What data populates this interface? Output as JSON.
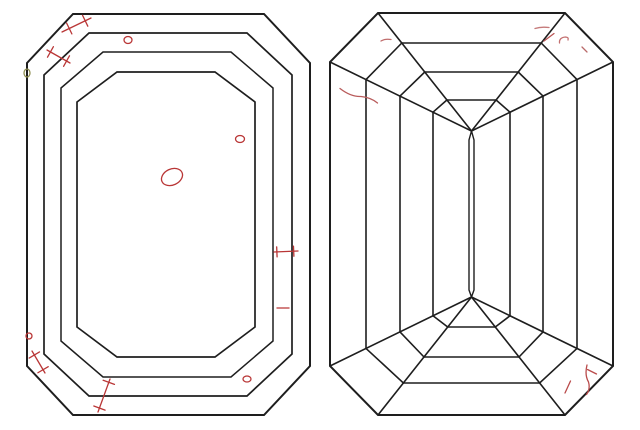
{
  "diagram": {
    "kind": "diamond-clarity-plot",
    "background": "#ffffff",
    "line_color": "#1e1e1e",
    "inclusion_color": "#b93636",
    "natural_color": "#8f8f52",
    "canvas": {
      "width": 640,
      "height": 430
    },
    "views": [
      {
        "name": "crown-view",
        "shapes": [
          {
            "type": "polygon",
            "name": "girdle-outline",
            "w": 2,
            "points": [
              [
                73,
                14
              ],
              [
                264,
                14
              ],
              [
                310,
                63
              ],
              [
                310,
                366
              ],
              [
                264,
                415
              ],
              [
                73,
                415
              ],
              [
                27,
                366
              ],
              [
                27,
                63
              ]
            ]
          },
          {
            "type": "polygon",
            "name": "crown-step-1",
            "w": 1.7,
            "points": [
              [
                89,
                33
              ],
              [
                247,
                33
              ],
              [
                292,
                75
              ],
              [
                292,
                354
              ],
              [
                247,
                396
              ],
              [
                89,
                396
              ],
              [
                44,
                354
              ],
              [
                44,
                75
              ]
            ]
          },
          {
            "type": "polygon",
            "name": "crown-step-2",
            "w": 1.5,
            "points": [
              [
                103,
                52
              ],
              [
                231,
                52
              ],
              [
                273,
                88
              ],
              [
                273,
                341
              ],
              [
                231,
                377
              ],
              [
                103,
                377
              ],
              [
                61,
                341
              ],
              [
                61,
                88
              ]
            ]
          },
          {
            "type": "polygon",
            "name": "table-outline",
            "w": 1.7,
            "points": [
              [
                117,
                72
              ],
              [
                215,
                72
              ],
              [
                255,
                102
              ],
              [
                255,
                327
              ],
              [
                215,
                357
              ],
              [
                117,
                357
              ],
              [
                77,
                327
              ],
              [
                77,
                102
              ]
            ]
          }
        ],
        "inclusions": [
          {
            "type": "feather",
            "name": "feather-mark",
            "x1": 62,
            "y1": 32,
            "x2": 91,
            "y2": 18,
            "ticks": [
              0.25,
              0.8
            ],
            "ticklen": 6
          },
          {
            "type": "feather",
            "name": "feather-mark",
            "x1": 47,
            "y1": 50,
            "x2": 70,
            "y2": 63,
            "ticks": [
              0.15,
              0.85
            ],
            "ticklen": 6
          },
          {
            "type": "ellipse",
            "name": "crystal-mark",
            "cx": 128,
            "cy": 40,
            "rx": 4,
            "ry": 3.5,
            "rot": 0
          },
          {
            "type": "ellipse",
            "name": "natural-mark",
            "cx": 27,
            "cy": 73,
            "rx": 3,
            "ry": 4,
            "rot": 0,
            "color": "#8f8f52"
          },
          {
            "type": "ellipse",
            "name": "crystal-mark",
            "cx": 172,
            "cy": 177,
            "rx": 11,
            "ry": 8,
            "rot": -25
          },
          {
            "type": "ellipse",
            "name": "crystal-mark",
            "cx": 240,
            "cy": 139,
            "rx": 4.5,
            "ry": 3.5,
            "rot": 0
          },
          {
            "type": "feather",
            "name": "feather-mark",
            "x1": 274,
            "y1": 252,
            "x2": 298,
            "y2": 251,
            "ticks": [
              0.12,
              0.82
            ],
            "ticklen": 5
          },
          {
            "type": "line",
            "name": "needle-mark",
            "x1": 277,
            "y1": 308,
            "x2": 289,
            "y2": 308
          },
          {
            "type": "ellipse",
            "name": "crystal-mark",
            "cx": 29,
            "cy": 336,
            "rx": 3,
            "ry": 3,
            "rot": 0
          },
          {
            "type": "feather",
            "name": "feather-mark",
            "x1": 32,
            "y1": 351,
            "x2": 45,
            "y2": 373,
            "ticks": [
              0.18,
              0.85
            ],
            "ticklen": 6
          },
          {
            "type": "feather",
            "name": "feather-mark",
            "x1": 110,
            "y1": 379,
            "x2": 98,
            "y2": 412,
            "ticks": [
              0.1,
              0.88
            ],
            "ticklen": 6
          },
          {
            "type": "ellipse",
            "name": "crystal-mark",
            "cx": 247,
            "cy": 379,
            "rx": 4,
            "ry": 3,
            "rot": 0
          }
        ]
      },
      {
        "name": "pavilion-view",
        "shapes": [
          {
            "type": "polygon",
            "name": "girdle-outline",
            "w": 2,
            "points": [
              [
                378,
                13
              ],
              [
                565,
                13
              ],
              [
                613,
                62
              ],
              [
                613,
                366
              ],
              [
                565,
                415
              ],
              [
                378,
                415
              ],
              [
                330,
                366
              ],
              [
                330,
                62
              ]
            ]
          },
          {
            "type": "line",
            "name": "corner-radial",
            "x1": 330,
            "y1": 62,
            "x2": 471.5,
            "y2": 131
          },
          {
            "type": "line",
            "name": "corner-radial",
            "x1": 378,
            "y1": 13,
            "x2": 471.5,
            "y2": 131
          },
          {
            "type": "line",
            "name": "corner-radial",
            "x1": 565,
            "y1": 13,
            "x2": 471.5,
            "y2": 131
          },
          {
            "type": "line",
            "name": "corner-radial",
            "x1": 613,
            "y1": 62,
            "x2": 471.5,
            "y2": 131
          },
          {
            "type": "line",
            "name": "corner-radial",
            "x1": 330,
            "y1": 366,
            "x2": 471.5,
            "y2": 297
          },
          {
            "type": "line",
            "name": "corner-radial",
            "x1": 378,
            "y1": 415,
            "x2": 471.5,
            "y2": 297
          },
          {
            "type": "line",
            "name": "corner-radial",
            "x1": 565,
            "y1": 415,
            "x2": 471.5,
            "y2": 297
          },
          {
            "type": "line",
            "name": "corner-radial",
            "x1": 613,
            "y1": 366,
            "x2": 471.5,
            "y2": 297
          },
          {
            "type": "line",
            "name": "pavilion-step-edge",
            "x1": 366,
            "y1": 79.6,
            "x2": 366,
            "y2": 348.4
          },
          {
            "type": "line",
            "name": "pavilion-step-edge",
            "x1": 400,
            "y1": 96.1,
            "x2": 400,
            "y2": 331.9
          },
          {
            "type": "line",
            "name": "pavilion-step-edge",
            "x1": 433,
            "y1": 112.2,
            "x2": 433,
            "y2": 315.8
          },
          {
            "type": "line",
            "name": "pavilion-step-edge",
            "x1": 577,
            "y1": 79.6,
            "x2": 577,
            "y2": 348.4
          },
          {
            "type": "line",
            "name": "pavilion-step-edge",
            "x1": 543,
            "y1": 96.1,
            "x2": 543,
            "y2": 331.9
          },
          {
            "type": "line",
            "name": "pavilion-step-edge",
            "x1": 510,
            "y1": 112.2,
            "x2": 510,
            "y2": 315.8
          },
          {
            "type": "line",
            "name": "pavilion-step-edge",
            "x1": 401.8,
            "y1": 43,
            "x2": 541.2,
            "y2": 43
          },
          {
            "type": "line",
            "name": "pavilion-step-edge",
            "x1": 424.8,
            "y1": 72,
            "x2": 518.2,
            "y2": 72
          },
          {
            "type": "line",
            "name": "pavilion-step-edge",
            "x1": 446.9,
            "y1": 100,
            "x2": 496.1,
            "y2": 100
          },
          {
            "type": "line",
            "name": "pavilion-step-edge",
            "x1": 403.4,
            "y1": 383,
            "x2": 539.6,
            "y2": 383
          },
          {
            "type": "line",
            "name": "pavilion-step-edge",
            "x1": 424,
            "y1": 357,
            "x2": 519,
            "y2": 357
          },
          {
            "type": "line",
            "name": "pavilion-step-edge",
            "x1": 447.7,
            "y1": 327,
            "x2": 495.3,
            "y2": 327
          },
          {
            "type": "line",
            "name": "corner-cut-line",
            "x1": 366,
            "y1": 79.6,
            "x2": 401.8,
            "y2": 43
          },
          {
            "type": "line",
            "name": "corner-cut-line",
            "x1": 400,
            "y1": 96.1,
            "x2": 424.8,
            "y2": 72
          },
          {
            "type": "line",
            "name": "corner-cut-line",
            "x1": 433,
            "y1": 112.2,
            "x2": 446.9,
            "y2": 100
          },
          {
            "type": "line",
            "name": "corner-cut-line",
            "x1": 541.2,
            "y1": 43,
            "x2": 577,
            "y2": 79.6
          },
          {
            "type": "line",
            "name": "corner-cut-line",
            "x1": 518.2,
            "y1": 72,
            "x2": 543,
            "y2": 96.1
          },
          {
            "type": "line",
            "name": "corner-cut-line",
            "x1": 496.1,
            "y1": 100,
            "x2": 510,
            "y2": 112.2
          },
          {
            "type": "line",
            "name": "corner-cut-line",
            "x1": 366,
            "y1": 348.4,
            "x2": 403.4,
            "y2": 383
          },
          {
            "type": "line",
            "name": "corner-cut-line",
            "x1": 400,
            "y1": 331.9,
            "x2": 424,
            "y2": 357
          },
          {
            "type": "line",
            "name": "corner-cut-line",
            "x1": 433,
            "y1": 315.8,
            "x2": 447.7,
            "y2": 327
          },
          {
            "type": "line",
            "name": "corner-cut-line",
            "x1": 539.6,
            "y1": 383,
            "x2": 577,
            "y2": 348.4
          },
          {
            "type": "line",
            "name": "corner-cut-line",
            "x1": 519,
            "y1": 357,
            "x2": 543,
            "y2": 331.9
          },
          {
            "type": "line",
            "name": "corner-cut-line",
            "x1": 495.3,
            "y1": 327,
            "x2": 510,
            "y2": 315.8
          },
          {
            "type": "path",
            "name": "keel-line",
            "d": "M471.5,131 L469,140 L469,290 L471.5,297",
            "w": 1.4
          },
          {
            "type": "path",
            "name": "keel-line",
            "d": "M471.5,131 L474,140 L474,290 L471.5,297",
            "w": 1.4
          }
        ],
        "inclusions": [
          {
            "type": "path",
            "name": "needle-mark",
            "d": "M381,41 Q385,38.5 391,39.5",
            "color": "#c06d6d"
          },
          {
            "type": "path",
            "name": "feather-mark",
            "d": "M340,88.5 Q351,97 361,96.5 Q371,97.5 377.5,103",
            "color": "#b95c5c"
          },
          {
            "type": "path",
            "name": "needle-mark",
            "d": "M535,28.5 Q541,26.5 549,27.5",
            "color": "#c57a7a"
          },
          {
            "type": "line",
            "name": "needle-mark",
            "x1": 544,
            "y1": 41,
            "x2": 554,
            "y2": 33.5,
            "color": "#b95555"
          },
          {
            "type": "path",
            "name": "feather-mark",
            "d": "M559.5,43 Q559,37.5 565.5,37 Q569,37.2 568,40",
            "color": "#c37070"
          },
          {
            "type": "line",
            "name": "needle-mark",
            "x1": 582,
            "y1": 47,
            "x2": 587,
            "y2": 52,
            "color": "#b96a6a"
          },
          {
            "type": "line",
            "name": "needle-mark",
            "x1": 565,
            "y1": 393,
            "x2": 570.5,
            "y2": 381,
            "color": "#b94a4a"
          },
          {
            "type": "path",
            "name": "feather-mark",
            "d": "M587,365 Q584.5,375 588.5,382 Q590.5,389 586.5,394.5",
            "color": "#b94a4a"
          },
          {
            "type": "line",
            "name": "needle-mark",
            "x1": 587.5,
            "y1": 369.5,
            "x2": 596.5,
            "y2": 374,
            "color": "#b94a4a"
          }
        ]
      }
    ]
  }
}
